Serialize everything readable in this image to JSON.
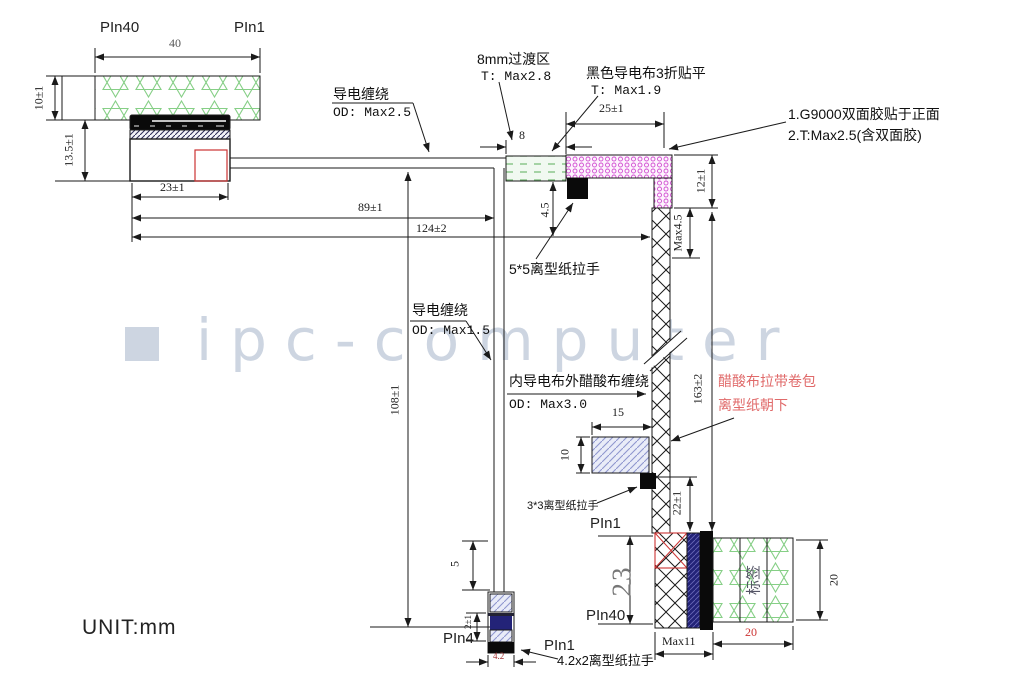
{
  "misc": {
    "unit": "UNIT:mm",
    "watermark": "ipc-computer"
  },
  "top": {
    "pin40": "PIn40",
    "pin1": "PIn1",
    "d40": "40",
    "d10": "10±1",
    "d135": "13.5±1",
    "d23": "23±1",
    "d89": "89±1",
    "d124": "124±2"
  },
  "notes": {
    "wrap_top_title": "导电缠绕",
    "wrap_top_sub": "OD: Max2.5",
    "transition_title": "8mm过渡区",
    "transition_sub": "T: Max2.8",
    "black_cloth_title": "黑色导电布3折贴平",
    "black_cloth_sub": "T: Max1.9",
    "g9000_line1": "1.G9000双面胶贴于正面",
    "g9000_line2": "2.T:Max2.5(含双面胶)",
    "pull_5x5": "5*5离型纸拉手",
    "wrap_mid_title": "导电缠绕",
    "wrap_mid_sub": "OD: Max1.5",
    "inner_wrap_title": "内导电布外醋酸布缠绕",
    "inner_wrap_sub": "OD: Max3.0",
    "acetate_line1": "醋酸布拉带卷包",
    "acetate_line2": "离型纸朝下",
    "pull_3x3": "3*3离型纸拉手",
    "pull_42": "4.2x2离型纸拉手"
  },
  "dims": {
    "d8": "8",
    "d25": "25±1",
    "d12": "12±1",
    "dmax45": "Max4.5",
    "d45": "4.5",
    "d108": "108±1",
    "d163": "163±2",
    "d15": "15",
    "d10": "10",
    "d22": "22±1"
  },
  "br": {
    "pin1": "PIn1",
    "pin40": "PIn40",
    "d23": "23",
    "dmax11": "Max11",
    "d20b": "20",
    "d20r": "20",
    "label": "标签"
  },
  "bs": {
    "pin4": "PIn4",
    "pin1": "PIn1",
    "d5": "5",
    "d42": "4.2",
    "d2": "2±1"
  },
  "colors": {
    "line": "#1a1a1a",
    "red_accent": "#cc3333",
    "red_note": "#e06a6a",
    "green_pattern": "#86cf86",
    "magenta_pattern": "#d24fd2",
    "navy": "#232378",
    "watermark": "#cdd5e1"
  }
}
